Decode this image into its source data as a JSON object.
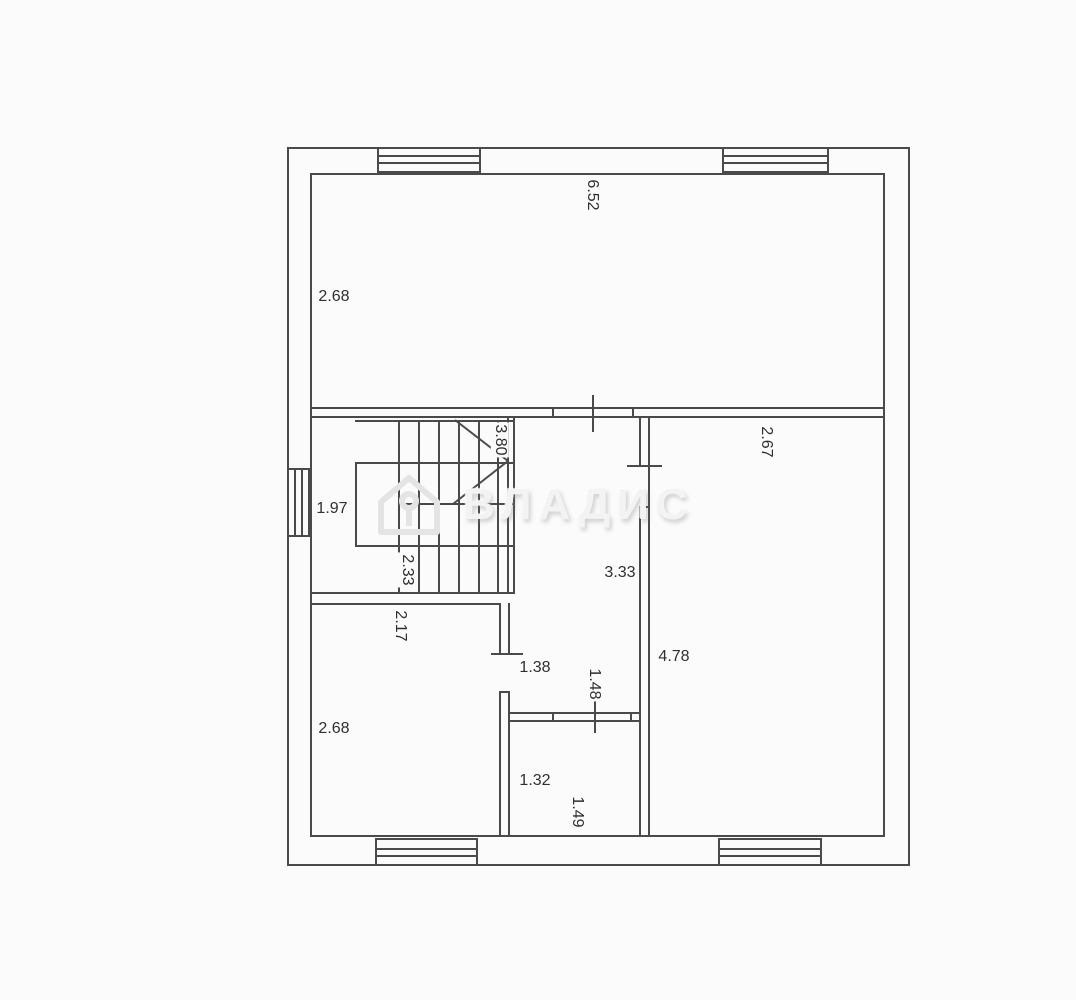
{
  "meta": {
    "background": "#fbfbfb",
    "line_color": "#4a4a4a",
    "label_color": "#2f2f2f",
    "watermark_color": "#f3f3f3"
  },
  "watermark": {
    "text": "ВЛАДИС",
    "logo": "house-icon"
  },
  "dimensions": {
    "top_room_width": "6.52",
    "top_room_height": "2.68",
    "right_room_width": "2.67",
    "right_room_height": "4.78",
    "stair_run": "3.80",
    "stair_depth": "1.97",
    "stair_width": "2.33",
    "left_room_width": "2.17",
    "left_room_height": "2.68",
    "hall_length": "3.33",
    "hall_width": "1.38",
    "wc_width": "1.48",
    "wc_height": "1.32",
    "wc_width_2": "1.49"
  }
}
